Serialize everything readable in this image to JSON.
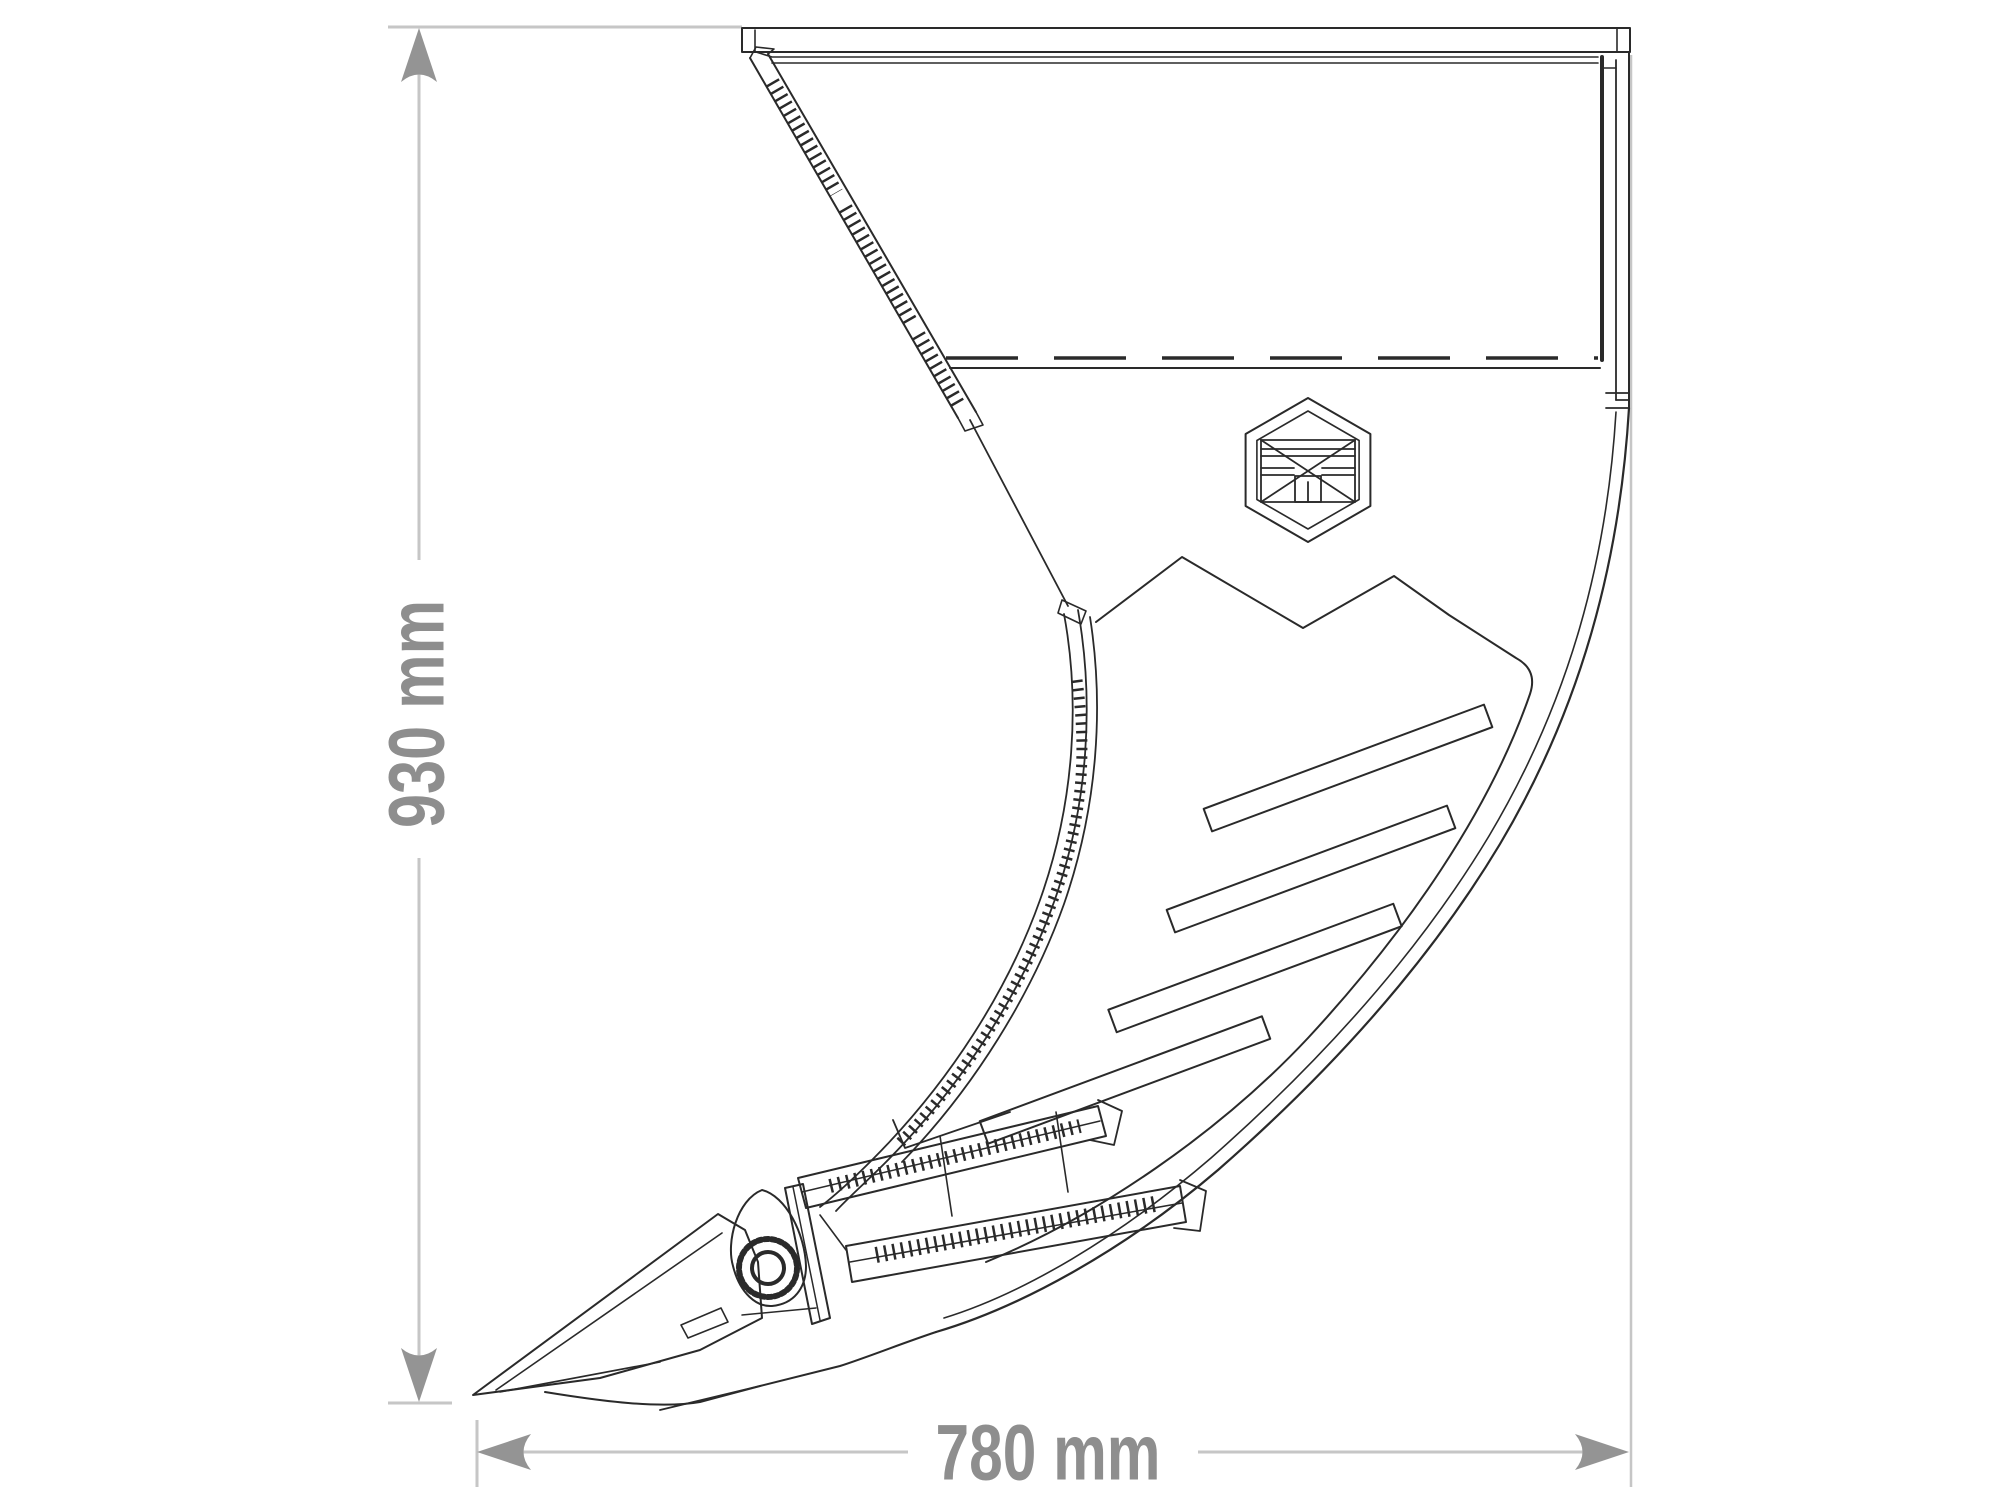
{
  "dimensions": {
    "height": {
      "label": "930 mm"
    },
    "width": {
      "label": "780 mm"
    },
    "label_color": "#8e8e8e",
    "arrow_color": "#949494",
    "line_color": "#c6c6c6"
  },
  "drawing": {
    "stroke_color": "#2a2a2a",
    "background": "#ffffff",
    "logo_icon": "hexagon-brand-emblem"
  }
}
